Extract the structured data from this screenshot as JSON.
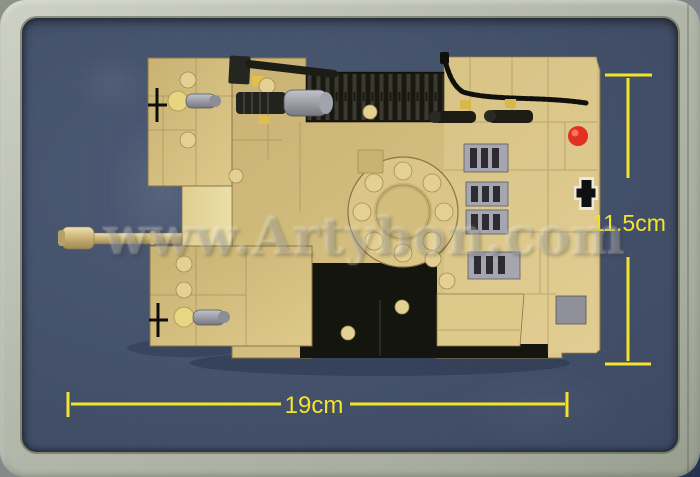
{
  "photo": {
    "subject": "Top view of a sand-colored brick-built toy tank displayed in a gray tray",
    "watermark": "www.Artybon.com",
    "dimensions": {
      "width": "19cm",
      "height": "11.5cm"
    },
    "decals": {
      "insignia": "german-cross",
      "marker": "red-dot"
    },
    "colors": {
      "tray_frame": "#b4b8ab",
      "tray_background": "#45526c",
      "dimension_yellow": "#f3e32b",
      "brick_tan": "#d6c07f",
      "brick_tan_light": "#e6d397",
      "track_black": "#181811",
      "accessory_gray": "#9a9aa2",
      "marker_red": "#e23120",
      "headlight_yellow": "#ead985"
    }
  }
}
